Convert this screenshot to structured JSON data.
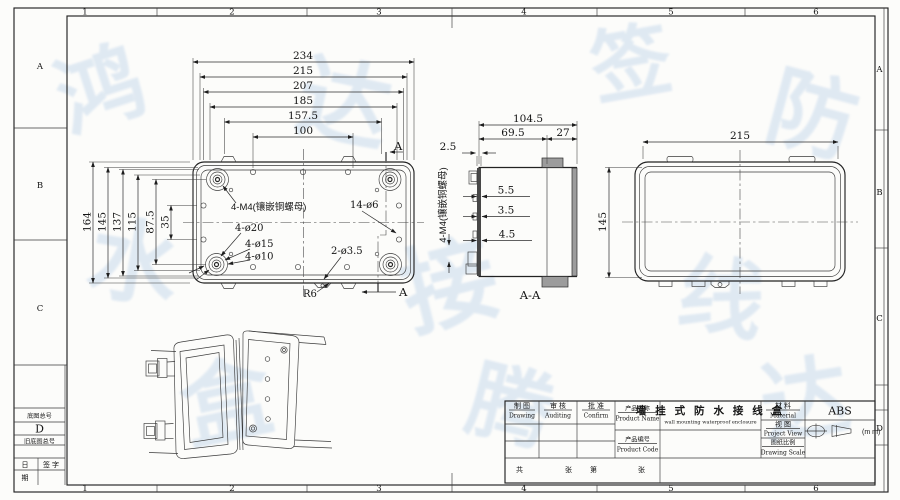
{
  "border": {
    "cols": [
      "1",
      "2",
      "3",
      "4",
      "5",
      "6"
    ],
    "rows_left": [
      "A",
      "B",
      "C"
    ],
    "rows_right": [
      "A",
      "B",
      "C",
      "D"
    ]
  },
  "plan": {
    "dims_top": [
      "234",
      "215",
      "207",
      "185",
      "157.5",
      "100"
    ],
    "dims_left": [
      "164",
      "145",
      "137",
      "115",
      "87.5",
      "35"
    ],
    "ann": {
      "m4": "4-M4(镶嵌铜螺母)",
      "holes": "14-ø6",
      "d20": "4-ø20",
      "d15": "4-ø15",
      "d10": "4-ø10",
      "d35": "2-ø3.5",
      "r6": "R6",
      "section_letter": "A"
    }
  },
  "section": {
    "dims": {
      "total": "104.5",
      "inner": "69.5",
      "lid": "27",
      "wall": "2.5",
      "s1": "5.5",
      "s2": "3.5",
      "s3": "4.5"
    },
    "m4": "4-M4(镶嵌铜螺母)",
    "label": "A-A"
  },
  "back": {
    "w": "215",
    "h": "145"
  },
  "title_block": {
    "drawing": {
      "cn": "制 图",
      "en": "Drawing"
    },
    "auditing": {
      "cn": "审 核",
      "en": "Auditing"
    },
    "confirm": {
      "cn": "批 准",
      "en": "Confirm"
    },
    "product_name": {
      "cn": "产品名称",
      "en": "Product Name"
    },
    "product_code": {
      "cn": "产品编号",
      "en": "Product Code"
    },
    "name_value": "墙 挂 式 防 水 接 线 盒",
    "name_value_en": "wall mounting waterproof enclosure",
    "material": {
      "cn": "材 料",
      "en": "Material"
    },
    "material_value": "ABS",
    "view": {
      "cn": "视 图",
      "en": "Project View"
    },
    "scale": {
      "cn": "图纸比例",
      "en": "Drawing Scale"
    },
    "unit": "(m m)",
    "sheet": {
      "gong": "共",
      "zhang1": "张",
      "di": "第",
      "zhang2": "张"
    }
  },
  "margin_block": {
    "base_no": "底图总号",
    "size": "D",
    "old_no": "旧底图总号",
    "ri": "日",
    "qi": "期",
    "sign": "签  字"
  },
  "watermark": {
    "glyphs": [
      "鸿",
      "达",
      "签",
      "防",
      "水",
      "接",
      "线",
      "盒",
      "腾",
      "达"
    ]
  }
}
